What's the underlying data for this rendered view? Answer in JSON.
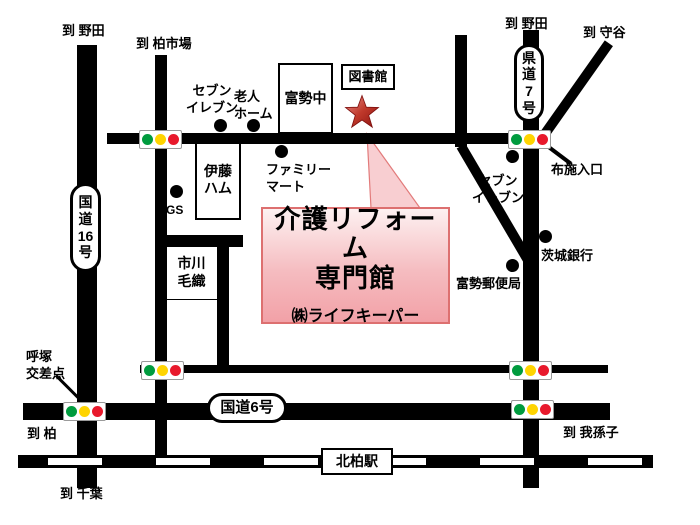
{
  "destinations": {
    "noda_left": "到 野田",
    "kashiwa_ichiba": "到 柏市場",
    "noda_right": "到 野田",
    "moriya": "到 守谷",
    "kashiwa": "到 柏",
    "chiba": "到 千葉",
    "abiko": "到 我孫子"
  },
  "road_badges": {
    "route16": [
      "国",
      "道",
      "16",
      "号"
    ],
    "kendo7": [
      "県",
      "道",
      "7",
      "号"
    ],
    "route6": "国道6号"
  },
  "buildings": {
    "fusei_junior_high": "富勢中",
    "library": "図書館",
    "ito_ham": [
      "伊藤",
      "ハム"
    ],
    "ichikawa_keori": [
      "市川",
      "毛織"
    ],
    "kitakashiwa_station": "北柏駅"
  },
  "pois": {
    "seven_eleven_left": [
      "セブン",
      "イレブン"
    ],
    "elderly_home": [
      "老人",
      "ホーム"
    ],
    "family_mart": [
      "ファミリー",
      "マート"
    ],
    "gas_station": "GS",
    "seven_eleven_right": [
      "セブン",
      "イレブン"
    ],
    "fuse_entrance": "布施入口",
    "ibaraki_bank": "茨城銀行",
    "fusei_post_office": "富勢郵便局",
    "yobitsuka_intersection": [
      "呼塚",
      "交差点"
    ]
  },
  "callout": {
    "title_line1": "介護リフォーム",
    "title_line2": "専門館",
    "company": "㈱ライフキーパー"
  },
  "icons": {
    "location_marker": "star-icon",
    "traffic_signal": "traffic-light-icon",
    "poi_marker": "dot-icon"
  },
  "traffic_light_colors": {
    "green": "#009b3e",
    "yellow": "#ffd400",
    "red": "#e8192c"
  },
  "map_colors": {
    "road": "#000000",
    "callout_border": "#dd7070",
    "callout_bg_top": "#fdf1f1",
    "callout_bg_bottom": "#f2a1a7",
    "star": "#b02a22"
  }
}
